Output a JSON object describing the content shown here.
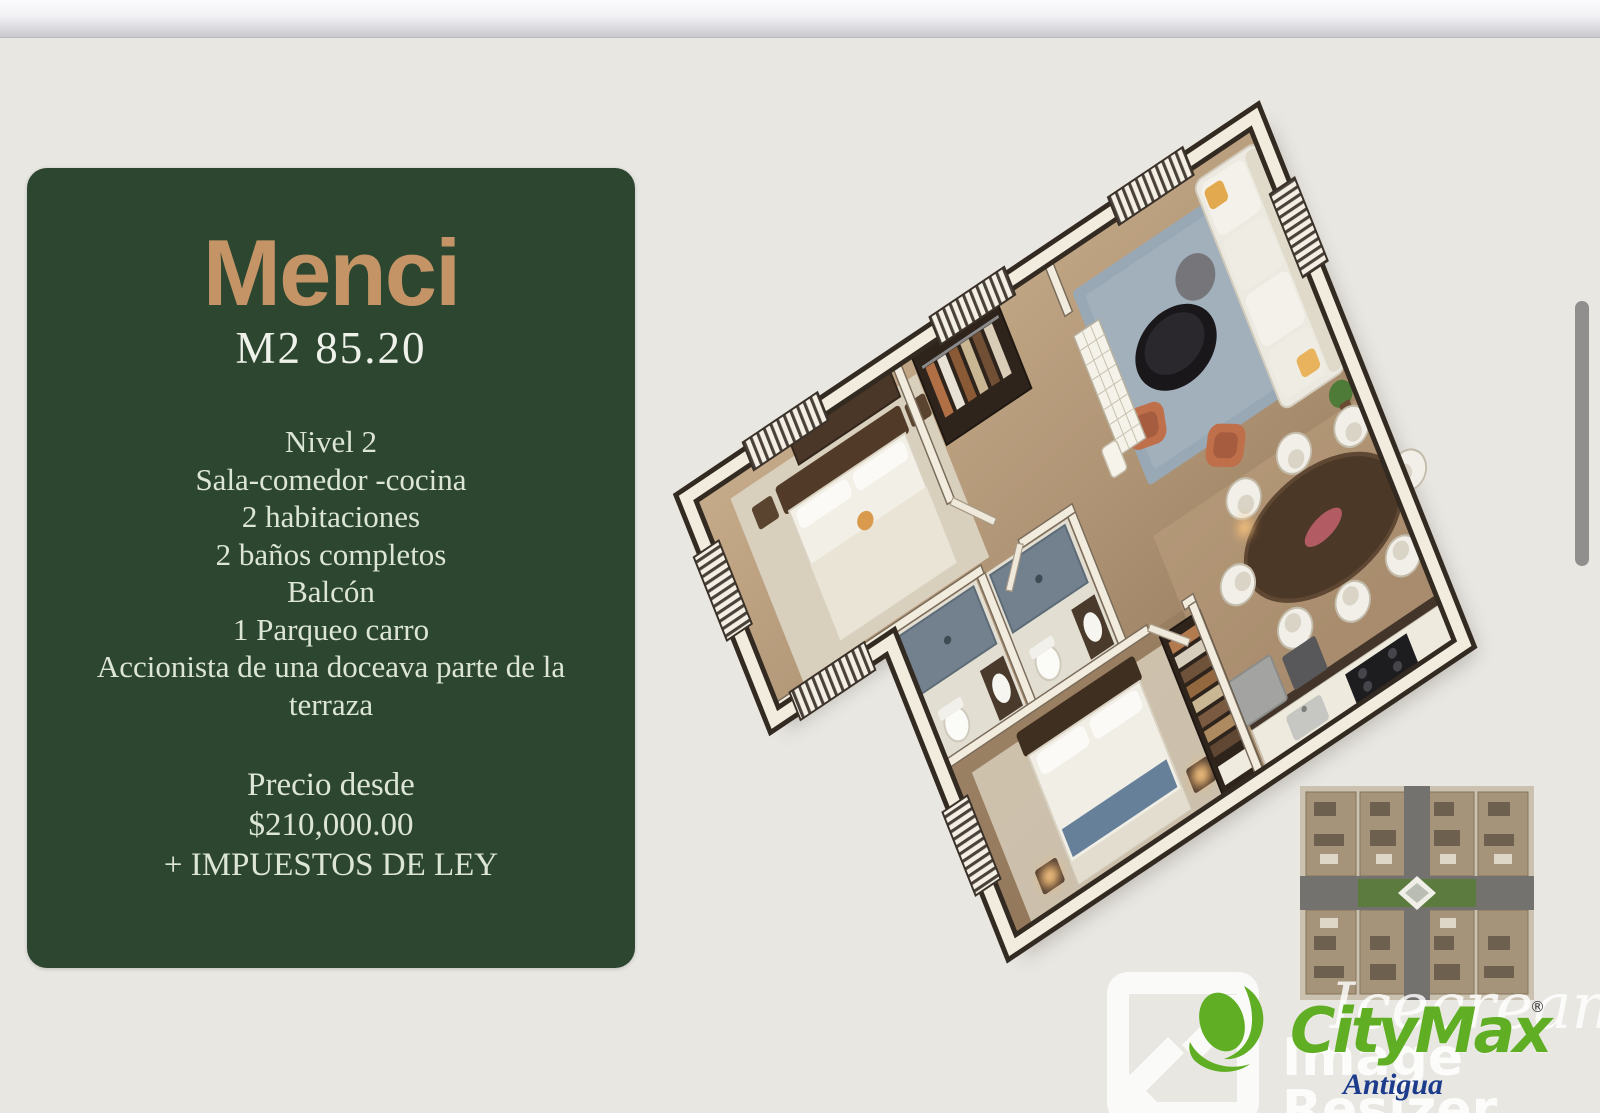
{
  "card": {
    "title": "Menci",
    "subtitle": "M2 85.20",
    "features": [
      "Nivel 2",
      "Sala-comedor -cocina",
      "2 habitaciones",
      "2 baños completos",
      "Balcón",
      "1 Parqueo carro",
      "Accionista de una doceava parte de la terraza"
    ],
    "price_label": "Precio desde",
    "price_amount": "$210,000.00",
    "price_note": "+ IMPUESTOS DE LEY",
    "accent_color": "#c49467",
    "panel_color": "#2c4630"
  },
  "branding": {
    "name": "CityMax",
    "registered": "®",
    "region": "Antigua",
    "green": "#5fae23",
    "blue": "#1d3c8c"
  },
  "watermark": {
    "script": "Icecream",
    "label": "Image Resizer"
  }
}
